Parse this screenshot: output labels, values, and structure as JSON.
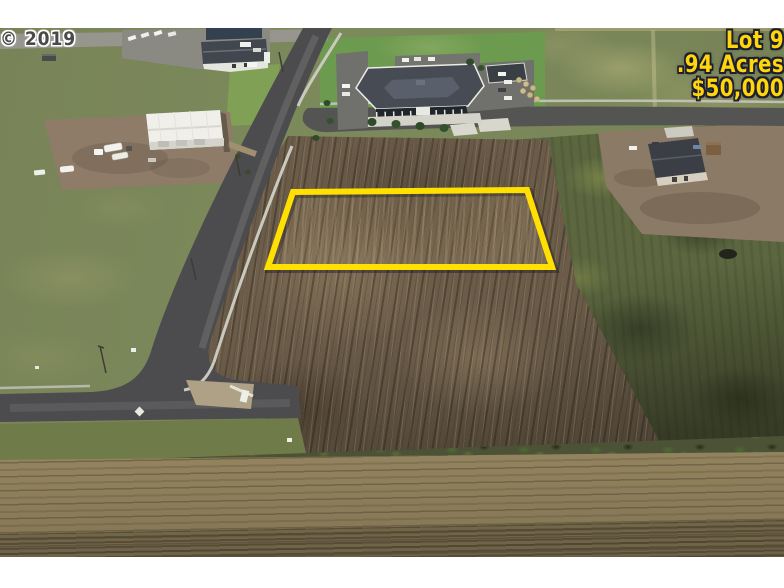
{
  "photo": {
    "watermark": "© 2019"
  },
  "lot_overlay": {
    "line1": "Lot 9",
    "line2": ".94 Acres",
    "line3": "$50,000"
  },
  "colors": {
    "lot_line": "#FFE000",
    "lot_text": "#FFD60A",
    "lot_text_outline": "#1E1E32",
    "watermark_text": "#4A4A4A"
  }
}
